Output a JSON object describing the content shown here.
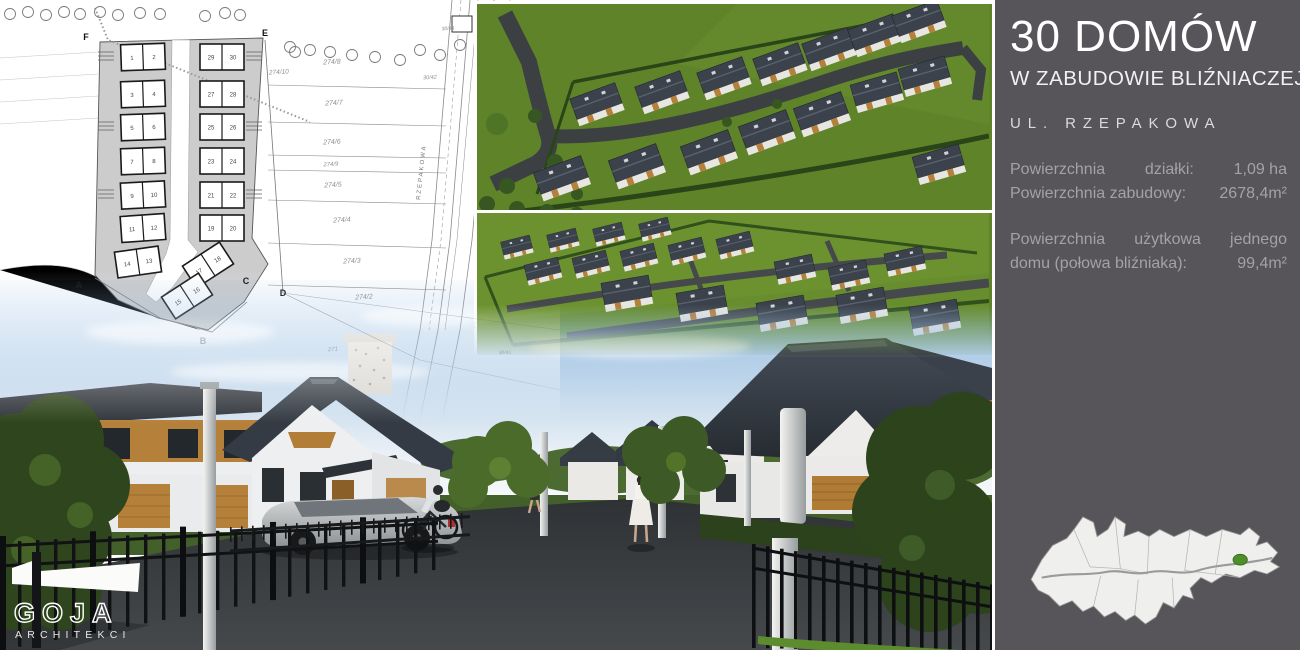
{
  "panel": {
    "bg_color": "#57545a",
    "title": "30 DOMÓW",
    "subtitle": "W ZABUDOWIE BLIŹNIACZEJ",
    "street": "UL. RZEPAKOWA",
    "specs": {
      "area_label_1": "Powierzchnia",
      "area_label_2": "działki:",
      "area_value": "1,09 ha",
      "built_label": "Powierzchnia zabudowy:",
      "built_value": "2678,4m²",
      "usable_word_1": "Powierzchnia",
      "usable_word_2": "użytkowa",
      "usable_word_3": "jednego",
      "usable_line2_label": "domu (połowa bliźniaka):",
      "usable_value": "99,4m²"
    }
  },
  "logo": {
    "name": "GOJA",
    "tagline": "ARCHITEKCI"
  },
  "map": {
    "marker_color": "#4e8f2a"
  },
  "site_plan": {
    "road_label": "RZEPAKOWA",
    "corner_letters": [
      {
        "t": "F",
        "x": 86,
        "y": 40
      },
      {
        "t": "E",
        "x": 265,
        "y": 36
      },
      {
        "t": "A",
        "x": 79,
        "y": 288
      },
      {
        "t": "B",
        "x": 203,
        "y": 344,
        "faint": true
      },
      {
        "t": "C",
        "x": 246,
        "y": 284
      },
      {
        "t": "D",
        "x": 283,
        "y": 296
      }
    ],
    "parcel_labels": [
      {
        "t": "274/10",
        "x": 279,
        "y": 74,
        "s": 6.5
      },
      {
        "t": "274/8",
        "x": 332,
        "y": 64,
        "s": 7
      },
      {
        "t": "274/7",
        "x": 334,
        "y": 105,
        "s": 7
      },
      {
        "t": "274/6",
        "x": 332,
        "y": 144,
        "s": 7
      },
      {
        "t": "274/9",
        "x": 331,
        "y": 166,
        "s": 6
      },
      {
        "t": "274/5",
        "x": 333,
        "y": 187,
        "s": 7
      },
      {
        "t": "274/4",
        "x": 342,
        "y": 222,
        "s": 7
      },
      {
        "t": "274/3",
        "x": 352,
        "y": 263,
        "s": 7
      },
      {
        "t": "274/2",
        "x": 364,
        "y": 299,
        "s": 7
      },
      {
        "t": "271",
        "x": 333,
        "y": 351,
        "s": 6
      },
      {
        "t": "30/42",
        "x": 430,
        "y": 79,
        "s": 5.5
      },
      {
        "t": "30/43",
        "x": 448,
        "y": 30,
        "s": 5
      },
      {
        "t": "30/41",
        "x": 505,
        "y": 354,
        "s": 5
      }
    ],
    "duplexes": [
      {
        "a": "1",
        "b": "2",
        "x": 121,
        "y": 44,
        "r": -2
      },
      {
        "a": "3",
        "b": "4",
        "x": 121,
        "y": 81,
        "r": -2
      },
      {
        "a": "5",
        "b": "6",
        "x": 121,
        "y": 114,
        "r": -2
      },
      {
        "a": "7",
        "b": "8",
        "x": 121,
        "y": 148,
        "r": -2
      },
      {
        "a": "9",
        "b": "10",
        "x": 121,
        "y": 182,
        "r": -3
      },
      {
        "a": "11",
        "b": "12",
        "x": 121,
        "y": 215,
        "r": -4
      },
      {
        "a": "14",
        "b": "13",
        "x": 116,
        "y": 249,
        "r": -8
      },
      {
        "a": "29",
        "b": "30",
        "x": 200,
        "y": 44,
        "r": 0
      },
      {
        "a": "27",
        "b": "28",
        "x": 200,
        "y": 81,
        "r": 0
      },
      {
        "a": "25",
        "b": "26",
        "x": 200,
        "y": 114,
        "r": 0
      },
      {
        "a": "23",
        "b": "24",
        "x": 200,
        "y": 148,
        "r": 0
      },
      {
        "a": "21",
        "b": "22",
        "x": 200,
        "y": 182,
        "r": 0
      },
      {
        "a": "19",
        "b": "20",
        "x": 200,
        "y": 215,
        "r": 0
      },
      {
        "a": "17",
        "b": "18",
        "x": 186,
        "y": 252,
        "r": -33
      },
      {
        "a": "15",
        "b": "16",
        "x": 165,
        "y": 283,
        "r": -33
      }
    ]
  }
}
